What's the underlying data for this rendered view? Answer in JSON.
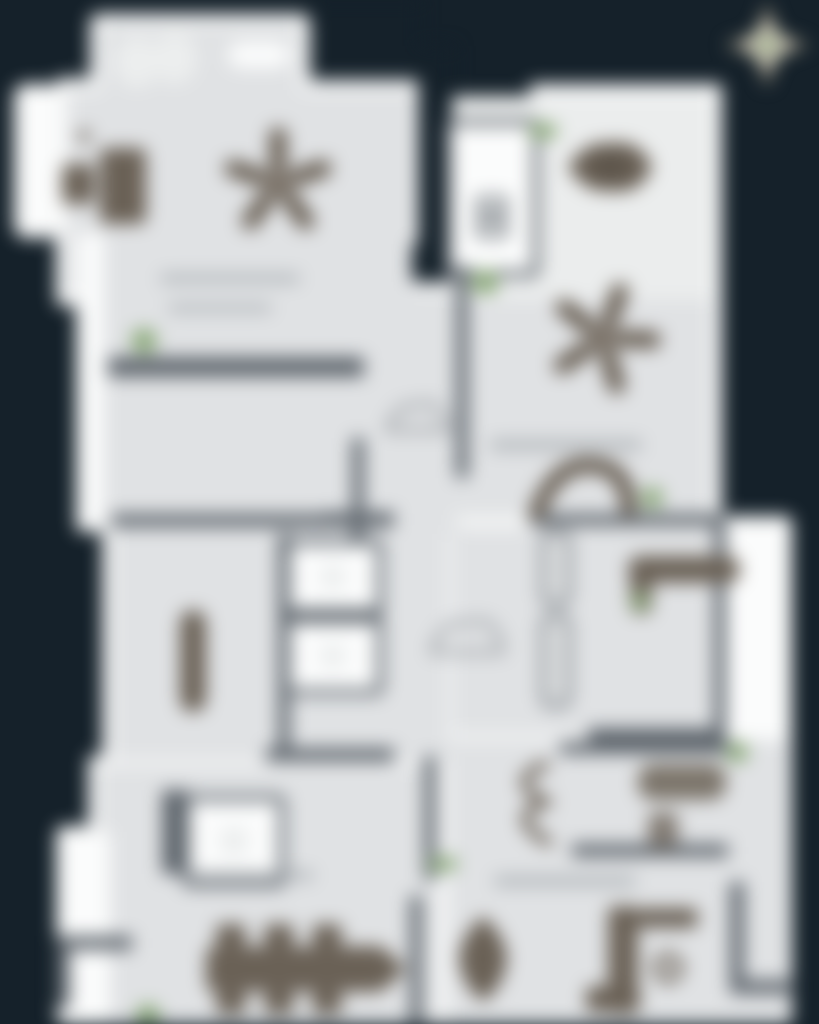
{
  "scene": {
    "kind": "blurred-architectural-floor-plan",
    "blur_px": 9,
    "background": "#15212a"
  },
  "palette": {
    "wall": "#5f666d",
    "floor": "#e0e2e4",
    "outer_white": "#f8f9f9",
    "furniture": "#6a6156",
    "accent_green": "#8dab7c",
    "compass_gray": "#8e897b",
    "compass_light": "#d2cdbd"
  },
  "compass": {
    "x": 767,
    "y": 45
  },
  "markers": [
    {
      "shape": "circle",
      "x": 144,
      "y": 341,
      "r": 13
    },
    {
      "shape": "pill",
      "x": 529,
      "y": 131,
      "w": 28,
      "h": 15
    },
    {
      "shape": "pill",
      "x": 472,
      "y": 282,
      "w": 26,
      "h": 24
    },
    {
      "shape": "circle",
      "x": 652,
      "y": 498,
      "r": 11
    },
    {
      "shape": "circle",
      "x": 640,
      "y": 601,
      "r": 9
    },
    {
      "shape": "circle",
      "x": 737,
      "y": 752,
      "r": 11
    },
    {
      "shape": "pill",
      "x": 429,
      "y": 864,
      "w": 28,
      "h": 14
    },
    {
      "shape": "circle",
      "x": 148,
      "y": 1016,
      "r": 12
    }
  ]
}
